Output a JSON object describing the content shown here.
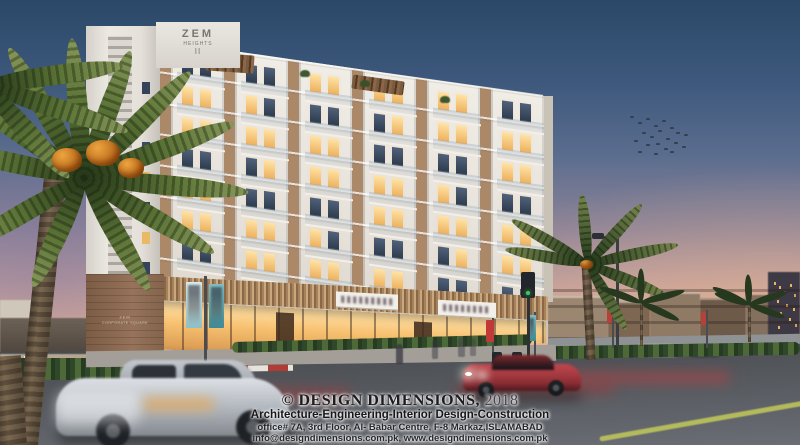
{
  "caption": {
    "copyright": "© DESIGN DIMENSIONS,",
    "year": "2018",
    "tagline": "Architecture-Engineering-Interior Design-Construction",
    "address": "office# 7A, 3rd Floor, Al- Babar Centre,  F-8 Markaz,ISLAMABAD",
    "contact": "info@designdimensions.com.pk, www.designdimensions.com.pk"
  },
  "building": {
    "rooftop_sign": {
      "name": "ZEM",
      "sub": "HEIGHTS",
      "number": "II"
    },
    "corner_sign": {
      "line1": "ZEM",
      "line2": "CORPORATE SQUARE"
    }
  },
  "palette": {
    "sky_top": "#2b4868",
    "sky_horizon": "#e6bb9f",
    "facade_white": "#ece8e1",
    "facade_brick": "#ab8868",
    "window_lit": "#f5c169",
    "storefront_glow": "#f7c170",
    "road": "#53565b",
    "hedge_green": "#30482a",
    "car_red": "#c2474e",
    "car_silver": "#c6cbd1",
    "banner_teal": "#5aa6b0"
  }
}
